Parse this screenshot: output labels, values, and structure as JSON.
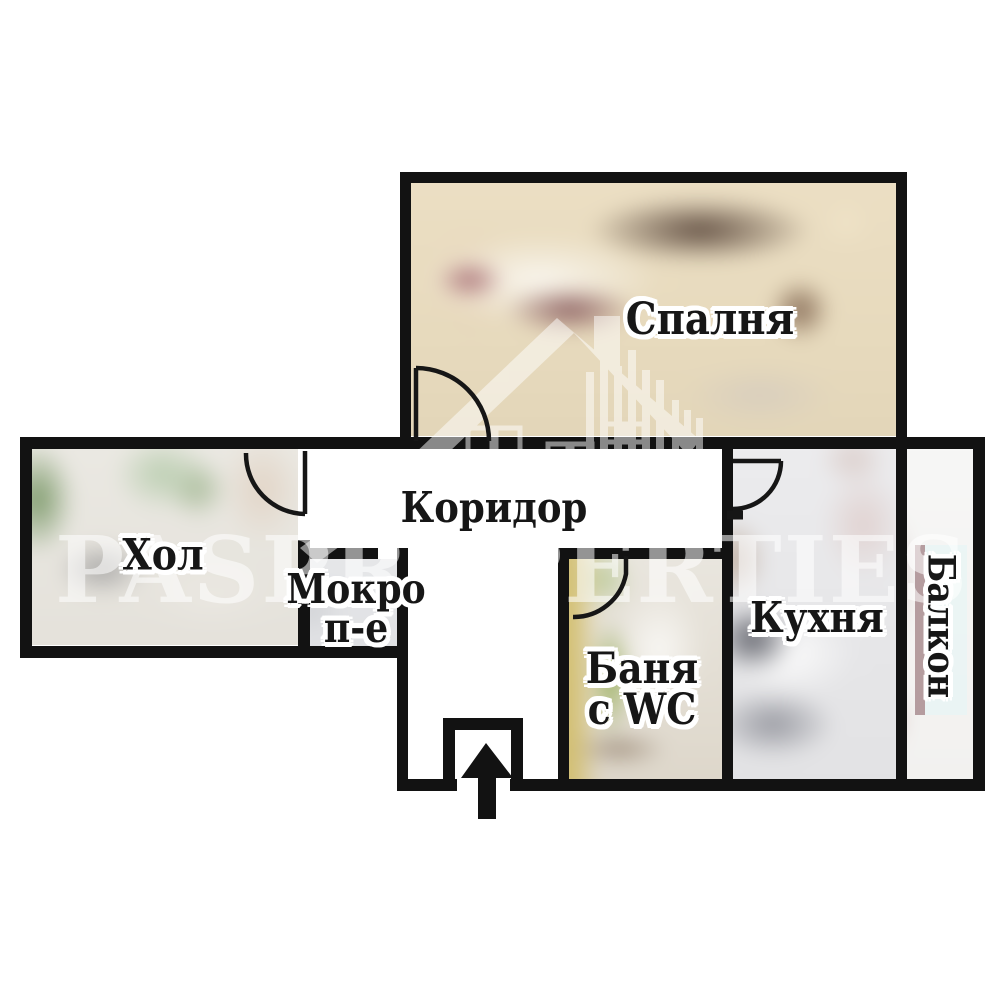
{
  "plan": {
    "type": "apartment-floor-plan",
    "background": "#ffffff",
    "wall_color": "#121212",
    "rooms": {
      "bedroom": {
        "label": "Спалня"
      },
      "hall": {
        "label": "Хол"
      },
      "corridor": {
        "label": "Коридор"
      },
      "wet_room": {
        "line1": "Мокро",
        "line2": "п-е"
      },
      "bathroom": {
        "line1": "Баня",
        "line2": "с WC"
      },
      "kitchen": {
        "label": "Кухня"
      },
      "balcony": {
        "label": "Балкон"
      }
    },
    "watermark": {
      "word1": "PAS",
      "word2": "PROPERTIES",
      "logo": "house-and-buildings",
      "color": "rgba(255,255,255,0.55)"
    },
    "entrance": {
      "icon": "arrow-up"
    }
  }
}
